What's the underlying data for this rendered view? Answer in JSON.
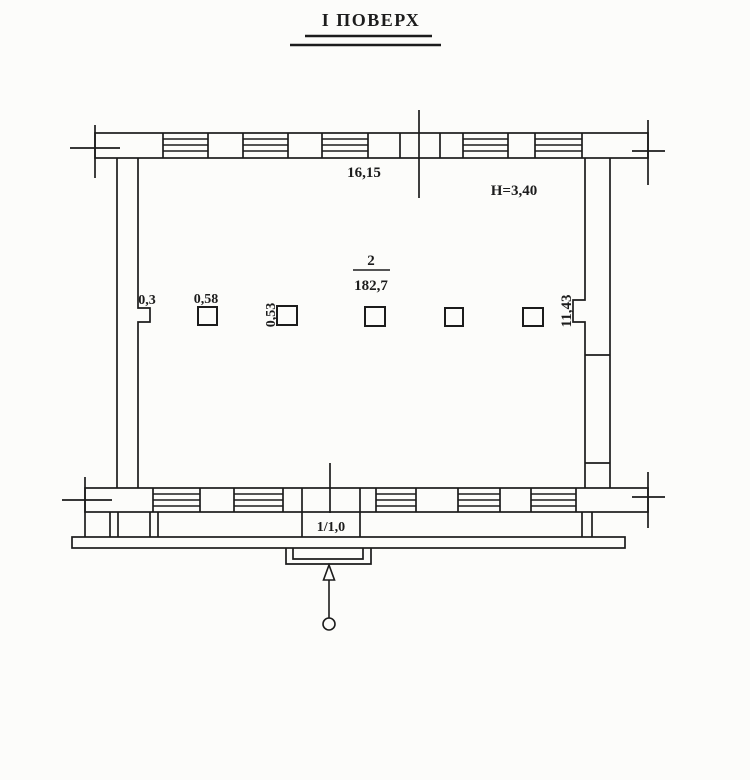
{
  "title": {
    "text": "І ПОВЕРХ"
  },
  "plan": {
    "room": {
      "number": "2",
      "area": "182,7"
    },
    "dimensions": {
      "top_width": "16,15",
      "ceiling_height": "Н=3,40",
      "wall_offset": "0,3",
      "column_width": "0,58",
      "column_depth": "0,53",
      "side_length": "11,43",
      "entrance_mark": "1/1,0"
    },
    "colors": {
      "ink": "#1c1c1c",
      "paper": "#fcfcfa"
    }
  }
}
